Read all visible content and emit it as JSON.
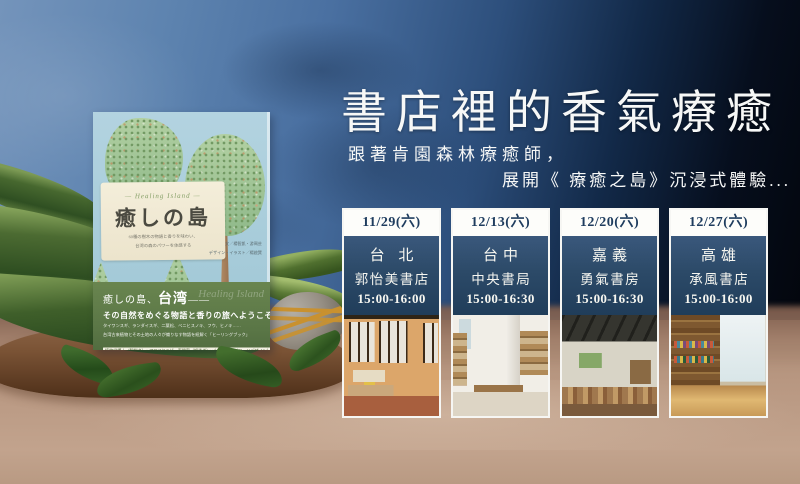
{
  "poster": {
    "headline": "書店裡的香氣療癒",
    "subtitle_line1": "跟著肯園森林療癒師，",
    "subtitle_line2": "展開《 療癒之島》沉浸式體驗..."
  },
  "book": {
    "script_title": "— Healing Island —",
    "title": "癒しの島",
    "tagline1": "60種の樹木の物語と香りを味わい、",
    "tagline2": "台湾の森のパワーを体感する",
    "credits1": "文／楊智凱・游珮芸",
    "credits2": "デザイン・イラスト／楊啟巽",
    "obi": {
      "lead": "癒しの島、",
      "lead_em": "台湾",
      "lead_dash": "——",
      "welcome": "その自然をめぐる物語と香りの旅へようこそ!",
      "detail1": "タイワンスギ、ランダイスギ、二葉松、ベニヒスノキ、フウ、ヒノキ……",
      "detail2": "台湾古来植物とその土地の人々が織りなす物語を紐解く「ヒーリングブック」",
      "boxed": "植物学博士（解説者）× アロマセラピー専門家（調香者）× 山岳ガイド（ロードデザイン）",
      "price": "全国書店にて発売　定価（本体2,200円＋税）",
      "watermark": "Healing Island"
    }
  },
  "events": [
    {
      "date": "11/29(六)",
      "city": "台 北",
      "store": "郭怡美書店",
      "time": "15:00-16:00"
    },
    {
      "date": "12/13(六)",
      "city": "台中",
      "store": "中央書局",
      "time": "15:00-16:30"
    },
    {
      "date": "12/20(六)",
      "city": "嘉義",
      "store": "勇氣書房",
      "time": "15:00-16:30"
    },
    {
      "date": "12/27(六)",
      "city": "高雄",
      "store": "承風書店",
      "time": "15:00-16:00"
    }
  ],
  "colors": {
    "sky_light": "#6e90b9",
    "sky_dark": "#060b14",
    "card_navy": "#2c4a68",
    "date_text": "#1e3c5e",
    "obi_green": "#5f7c4c",
    "cover_blue": "#abcfdc",
    "table_tan": "#b6957f"
  }
}
